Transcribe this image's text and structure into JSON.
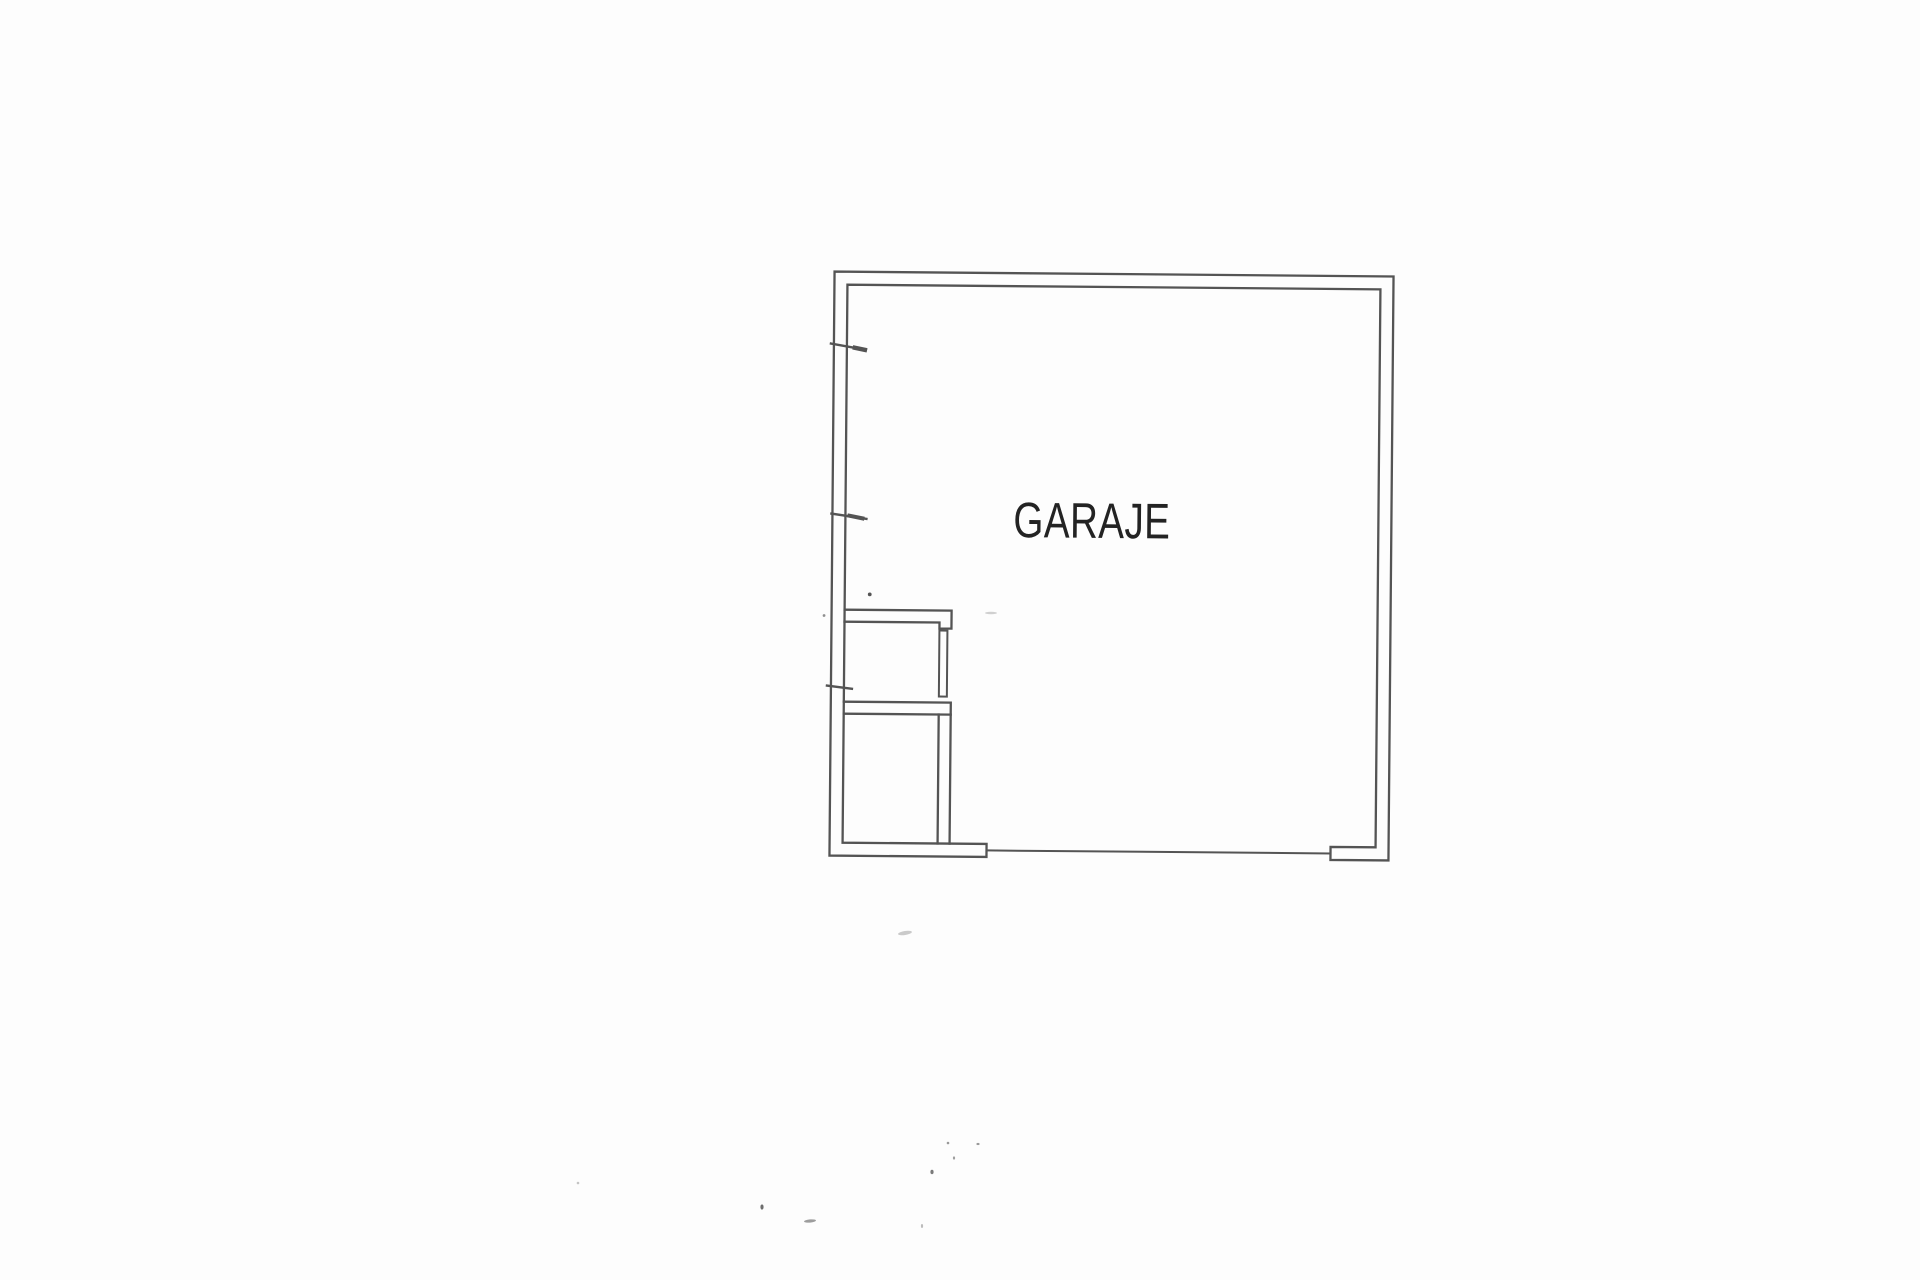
{
  "page": {
    "paper_color": "#fdfdfd"
  },
  "plan": {
    "room_label": "GARAJE",
    "ink_color": "#545454",
    "label_color": "#232323"
  }
}
